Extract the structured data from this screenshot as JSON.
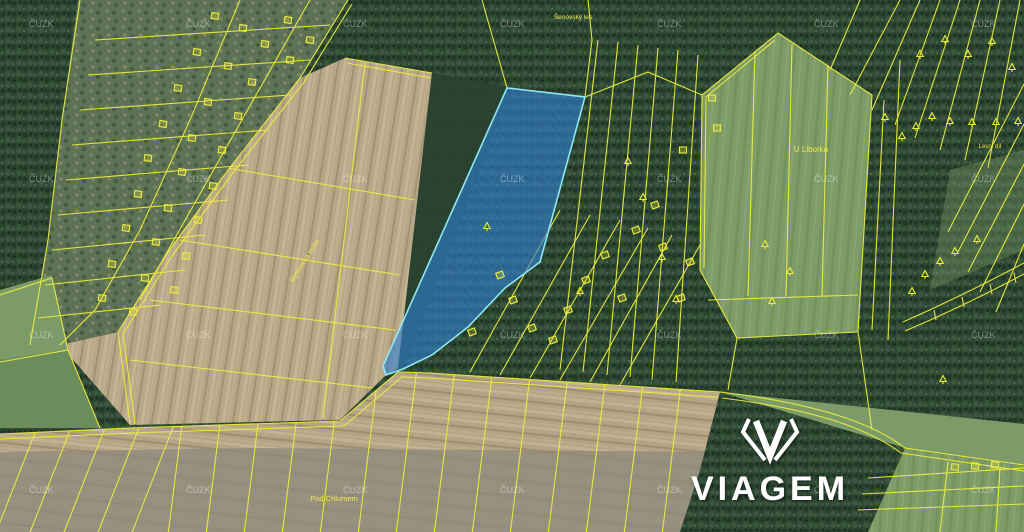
{
  "map": {
    "type": "cadastral-satellite-map",
    "watermark": {
      "text": "ČUZK",
      "color": "rgba(255,255,255,0.38)",
      "grid_xs": [
        29,
        186,
        343,
        500,
        657,
        814,
        971
      ],
      "grid_ys": [
        27,
        182,
        338,
        493
      ]
    },
    "labels": [
      {
        "id": "u-liborka",
        "text": "U Liborka",
        "x": 811,
        "y": 152,
        "size": 8,
        "rotate": 0
      },
      {
        "id": "pod-chlumem",
        "text": "Pod Chlumem",
        "x": 334,
        "y": 501,
        "size": 7.5,
        "rotate": 0
      },
      {
        "id": "road-name",
        "text": "Myslivecká cesta",
        "x": 306,
        "y": 262,
        "size": 6.5,
        "rotate": -58
      },
      {
        "id": "forest-name",
        "text": "Šenovský les",
        "x": 573,
        "y": 19,
        "size": 6.5,
        "rotate": 0
      },
      {
        "id": "lesni-dil",
        "text": "Lesní díl",
        "x": 990,
        "y": 148,
        "size": 6,
        "rotate": 0
      }
    ],
    "colors": {
      "boundary_yellow": "#ecec3d",
      "label_text": "#efe84e",
      "parcel_fill": "#2e7fd0",
      "parcel_border": "#8fe8f2",
      "forest_green": "#2d4832",
      "field_tan": "#b8a787",
      "field_grey": "#8d897c",
      "meadow_green": "#7e9c68",
      "logo_white": "#ffffff"
    },
    "highlighted_parcel": {
      "name": "offered-land-parcel",
      "fill_opacity": 0.62
    },
    "tree_symbols": [
      [
        628,
        162
      ],
      [
        643,
        198
      ],
      [
        662,
        258
      ],
      [
        676,
        300
      ],
      [
        580,
        292
      ],
      [
        487,
        227
      ],
      [
        765,
        245
      ],
      [
        772,
        302
      ],
      [
        790,
        272
      ],
      [
        885,
        118
      ],
      [
        902,
        137
      ],
      [
        916,
        127
      ],
      [
        932,
        117
      ],
      [
        950,
        122
      ],
      [
        972,
        123
      ],
      [
        996,
        123
      ],
      [
        1018,
        122
      ],
      [
        920,
        55
      ],
      [
        945,
        40
      ],
      [
        968,
        55
      ],
      [
        992,
        42
      ],
      [
        1012,
        68
      ],
      [
        912,
        292
      ],
      [
        925,
        275
      ],
      [
        940,
        262
      ],
      [
        955,
        252
      ],
      [
        977,
        240
      ],
      [
        943,
        380
      ]
    ],
    "building_markers": [
      [
        215,
        16,
        8
      ],
      [
        243,
        28,
        8
      ],
      [
        265,
        44,
        8
      ],
      [
        197,
        52,
        8
      ],
      [
        228,
        66,
        8
      ],
      [
        252,
        82,
        8
      ],
      [
        178,
        88,
        8
      ],
      [
        208,
        102,
        8
      ],
      [
        238,
        116,
        8
      ],
      [
        163,
        124,
        8
      ],
      [
        192,
        138,
        8
      ],
      [
        222,
        150,
        8
      ],
      [
        148,
        158,
        8
      ],
      [
        182,
        172,
        8
      ],
      [
        213,
        186,
        8
      ],
      [
        138,
        194,
        8
      ],
      [
        168,
        208,
        8
      ],
      [
        198,
        220,
        8
      ],
      [
        126,
        228,
        8
      ],
      [
        156,
        242,
        8
      ],
      [
        186,
        256,
        8
      ],
      [
        112,
        264,
        8
      ],
      [
        145,
        278,
        8
      ],
      [
        174,
        290,
        8
      ],
      [
        102,
        298,
        8
      ],
      [
        133,
        312,
        8
      ],
      [
        288,
        20,
        8
      ],
      [
        310,
        40,
        8
      ],
      [
        290,
        60,
        8
      ],
      [
        500,
        275,
        -20
      ],
      [
        513,
        300,
        -20
      ],
      [
        532,
        328,
        -20
      ],
      [
        553,
        340,
        -20
      ],
      [
        568,
        310,
        -20
      ],
      [
        586,
        280,
        -20
      ],
      [
        605,
        255,
        -20
      ],
      [
        622,
        298,
        -20
      ],
      [
        636,
        230,
        -20
      ],
      [
        655,
        205,
        -20
      ],
      [
        663,
        247,
        -20
      ],
      [
        681,
        298,
        -20
      ],
      [
        690,
        262,
        -20
      ],
      [
        472,
        332,
        -20
      ],
      [
        712,
        98,
        0
      ],
      [
        717,
        128,
        0
      ],
      [
        683,
        150,
        0
      ],
      [
        955,
        467,
        5
      ],
      [
        975,
        466,
        5
      ],
      [
        995,
        465,
        5
      ]
    ]
  },
  "logo": {
    "text": "VIAGEM",
    "icon": "viagem-gem-icon",
    "color": "#ffffff"
  }
}
